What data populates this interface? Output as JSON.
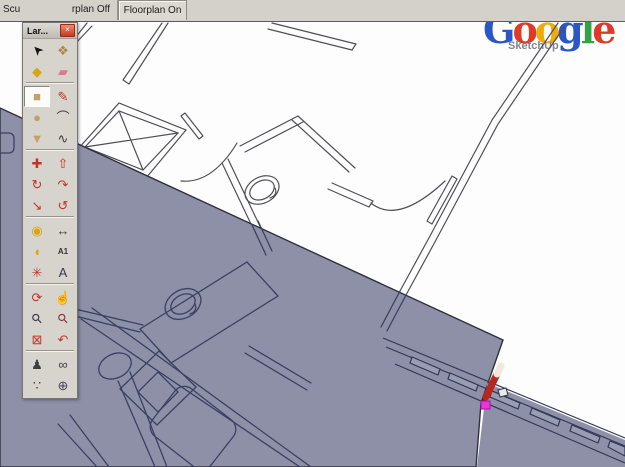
{
  "colors": {
    "floor_face": "#8d90a6",
    "edge_dark": "#4f4f55",
    "edge_shaded": "#3c4062",
    "inference_point": "#ee35d8",
    "tab_strip": "#d4d1ca",
    "palette_bg": "#d7d4cd",
    "close_button": "#c43a20",
    "pencil_red": "#b6281e"
  },
  "tab_strip": {
    "tabs": [
      {
        "label": "Scu"
      },
      {
        "label": "rplan Off"
      },
      {
        "label": "Floorplan On",
        "selected": true
      }
    ]
  },
  "logo": {
    "letters": [
      {
        "ch": "G",
        "color": "#2a56c6"
      },
      {
        "ch": "o",
        "color": "#dd3a2a"
      },
      {
        "ch": "o",
        "color": "#efac08"
      },
      {
        "ch": "g",
        "color": "#2a56c6"
      },
      {
        "ch": "l",
        "color": "#30a346"
      },
      {
        "ch": "e",
        "color": "#dd3a2a"
      }
    ],
    "subtitle": "SketchUp"
  },
  "palette": {
    "title": "Lar...",
    "close_glyph": "×",
    "sep_after_rows": [
      2,
      5,
      8,
      11,
      14
    ],
    "tools": [
      {
        "name": "select-tool",
        "glyph": "➤",
        "color": "#141414",
        "rot": -135
      },
      {
        "name": "make-component-tool",
        "glyph": "❖",
        "color": "#b08648"
      },
      {
        "name": "paint-bucket-tool",
        "glyph": "◆",
        "color": "#d8a515"
      },
      {
        "name": "eraser-tool",
        "glyph": "▰",
        "color": "#e8738f"
      },
      {
        "name": "rectangle-tool",
        "glyph": "■",
        "color": "#c2a06a",
        "pressed": true
      },
      {
        "name": "line-tool",
        "glyph": "✎",
        "color": "#c03528"
      },
      {
        "name": "circle-tool",
        "glyph": "●",
        "color": "#c2a06a"
      },
      {
        "name": "arc-tool",
        "glyph": "⌒",
        "color": "#3d3d44"
      },
      {
        "name": "polygon-tool",
        "glyph": "▼",
        "color": "#c2a06a"
      },
      {
        "name": "freehand-tool",
        "glyph": "∿",
        "color": "#3d3d44"
      },
      {
        "name": "move-tool",
        "glyph": "✚",
        "color": "#c03528"
      },
      {
        "name": "push-pull-tool",
        "glyph": "⇧",
        "color": "#c03528"
      },
      {
        "name": "rotate-tool",
        "glyph": "↻",
        "color": "#c03528"
      },
      {
        "name": "follow-me-tool",
        "glyph": "↷",
        "color": "#c03528"
      },
      {
        "name": "scale-tool",
        "glyph": "↘",
        "color": "#c03528"
      },
      {
        "name": "offset-tool",
        "glyph": "↺",
        "color": "#c03528"
      },
      {
        "name": "tape-measure-tool",
        "glyph": "◉",
        "color": "#d8a515"
      },
      {
        "name": "dimension-tool",
        "glyph": "↔",
        "color": "#3d3d44"
      },
      {
        "name": "protractor-tool",
        "glyph": "◖",
        "color": "#d8a515"
      },
      {
        "name": "text-tool",
        "glyph": "A1",
        "color": "#333333",
        "small": true
      },
      {
        "name": "axes-tool",
        "glyph": "✳",
        "color": "#c03528"
      },
      {
        "name": "3d-text-tool",
        "glyph": "A",
        "color": "#38384e"
      },
      {
        "name": "orbit-tool",
        "glyph": "⟳",
        "color": "#c03528"
      },
      {
        "name": "pan-tool",
        "glyph": "☝",
        "color": "#8a8a8a"
      },
      {
        "name": "zoom-tool",
        "glyph": "⚲",
        "color": "#33364d",
        "rot": -45
      },
      {
        "name": "zoom-window-tool",
        "glyph": "⚲",
        "color": "#8d2f3b",
        "rot": -45
      },
      {
        "name": "zoom-extents-tool",
        "glyph": "⊠",
        "color": "#c03528"
      },
      {
        "name": "zoom-previous-tool",
        "glyph": "↶",
        "color": "#c03528"
      },
      {
        "name": "position-camera-tool",
        "glyph": "♟",
        "color": "#3d3d44"
      },
      {
        "name": "look-around-tool",
        "glyph": "∞",
        "color": "#3d3d44"
      },
      {
        "name": "walk-tool",
        "glyph": "∵",
        "color": "#3d3d44"
      },
      {
        "name": "section-plane-tool",
        "glyph": "⊕",
        "color": "#44465e"
      }
    ]
  },
  "canvas": {
    "active_cursor": "line-tool-pencil",
    "inference_color": "#ee35d8"
  }
}
